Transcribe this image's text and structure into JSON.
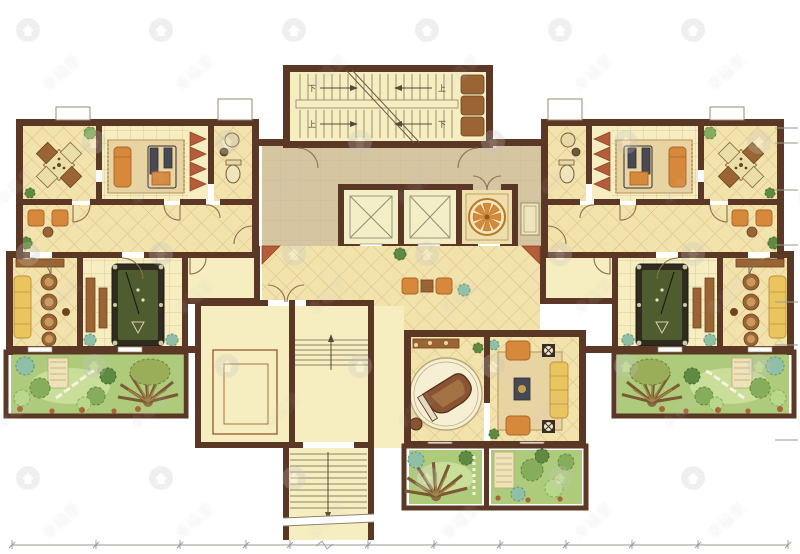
{
  "plan": {
    "stair_labels": {
      "up": "上",
      "down": "下"
    },
    "watermark": {
      "text": "幸福里",
      "icon": "house-circle-icon"
    }
  },
  "colors": {
    "wall": "#5b3726",
    "floorPale": "#f6eec0",
    "floorTile": "#f2e2ac",
    "tileLine": "#d9bd84",
    "gridLine": "#cfc093",
    "corridor": "#d6c5a1",
    "corridorLine": "#c2b08c",
    "lobbyFloor": "#eedfae",
    "elevator": "#f4eec6",
    "elevLine": "#8f8f73",
    "rug": "#e8d3a2",
    "rugBorder": "#c1a066",
    "orange": "#d6893b",
    "orangeDark": "#a96427",
    "wood": "#9a6434",
    "woodDark": "#6e441f",
    "yellowSofa": "#eac45e",
    "equipment": "#474a55",
    "felt": "#4e5c2f",
    "feltFrame": "#2f2b1f",
    "redStep": "#b35d3a",
    "grass": "#aecb7c",
    "grassLight": "#cfe3a0",
    "treeDark": "#5f8a42",
    "treeMid": "#86ad5b",
    "treeLight": "#b9d98a",
    "bushTeal": "#8fbfa6",
    "rock": "#a8643a",
    "dim": "#9a9a8c",
    "watermark": "#c2c2c2",
    "doorArc": "#8a7050",
    "white": "#ffffff"
  }
}
